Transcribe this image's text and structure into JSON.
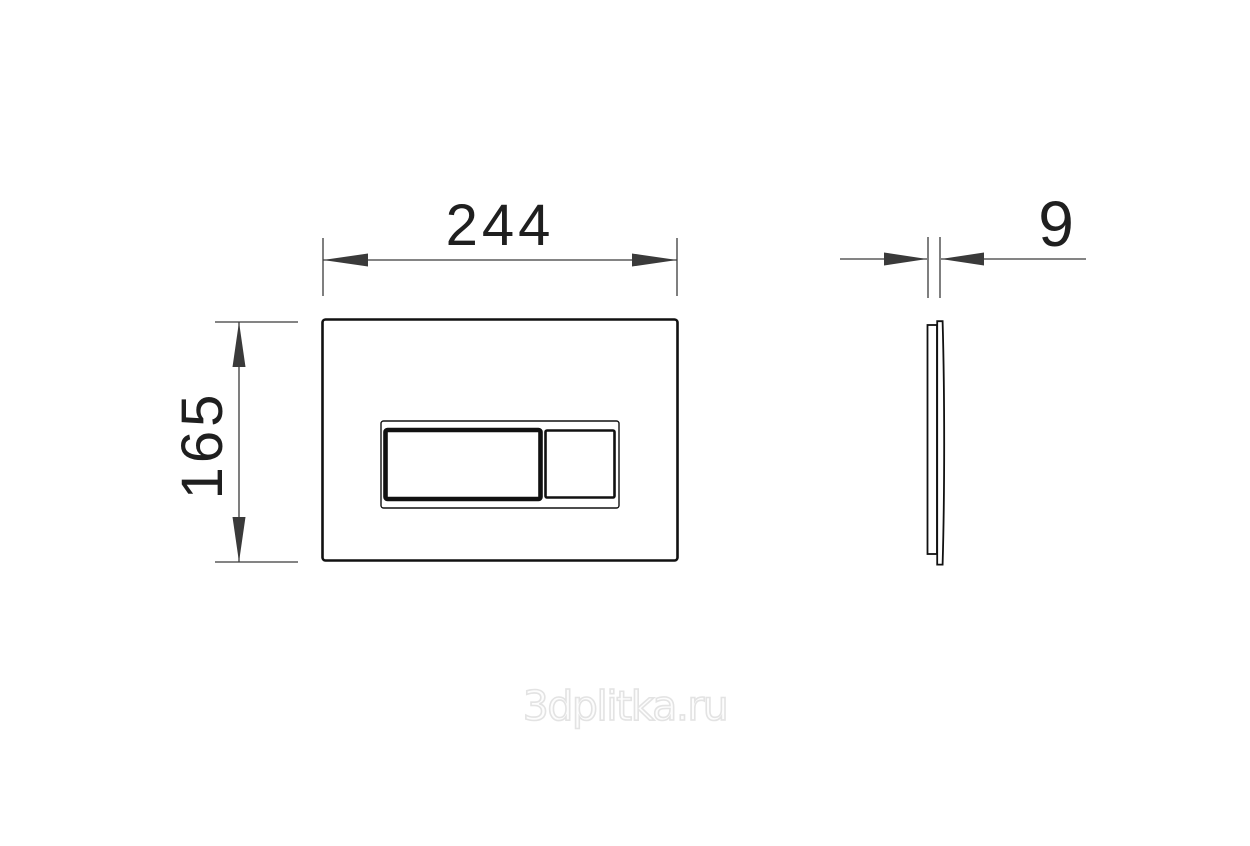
{
  "drawing": {
    "dimensions": {
      "width_label": "244",
      "height_label": "165",
      "thickness_label": "9"
    },
    "watermark": {
      "text": "3dplitka.ru",
      "color": "#e3e3e3"
    },
    "colors": {
      "outline": "#111111",
      "dimension": "#3a3a3a",
      "label": "#1f1f1f",
      "background": "#ffffff"
    }
  }
}
